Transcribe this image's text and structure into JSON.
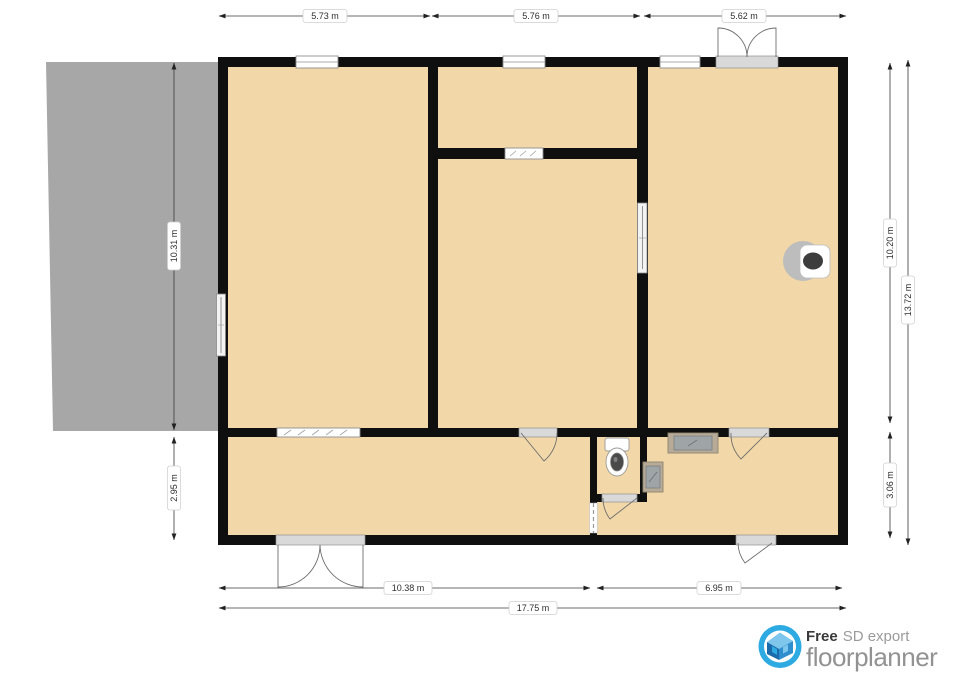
{
  "plan": {
    "type": "floor-plan-export",
    "dimensions": {
      "top": [
        "5.73 m",
        "5.76 m",
        "5.62 m"
      ],
      "left": [
        "10.31 m",
        "2.95 m"
      ],
      "right": [
        "10.20 m",
        "3.06 m",
        "13.72 m"
      ],
      "bottom": [
        "10.38 m",
        "6.95 m",
        "17.75 m"
      ]
    },
    "colors": {
      "floor": "#f2d8a8",
      "wall": "#0f0f0f",
      "deck": "#a7a7a7",
      "window_fill": "#ffffff",
      "dimension_text": "#2e2e2e",
      "logo_blue": "#2daae1",
      "logo_dark_blue": "#1b6aab",
      "logo_text_gray": "#929292"
    }
  },
  "branding": {
    "free_label": "Free",
    "export_label": "SD export",
    "brand": "floorplanner"
  }
}
